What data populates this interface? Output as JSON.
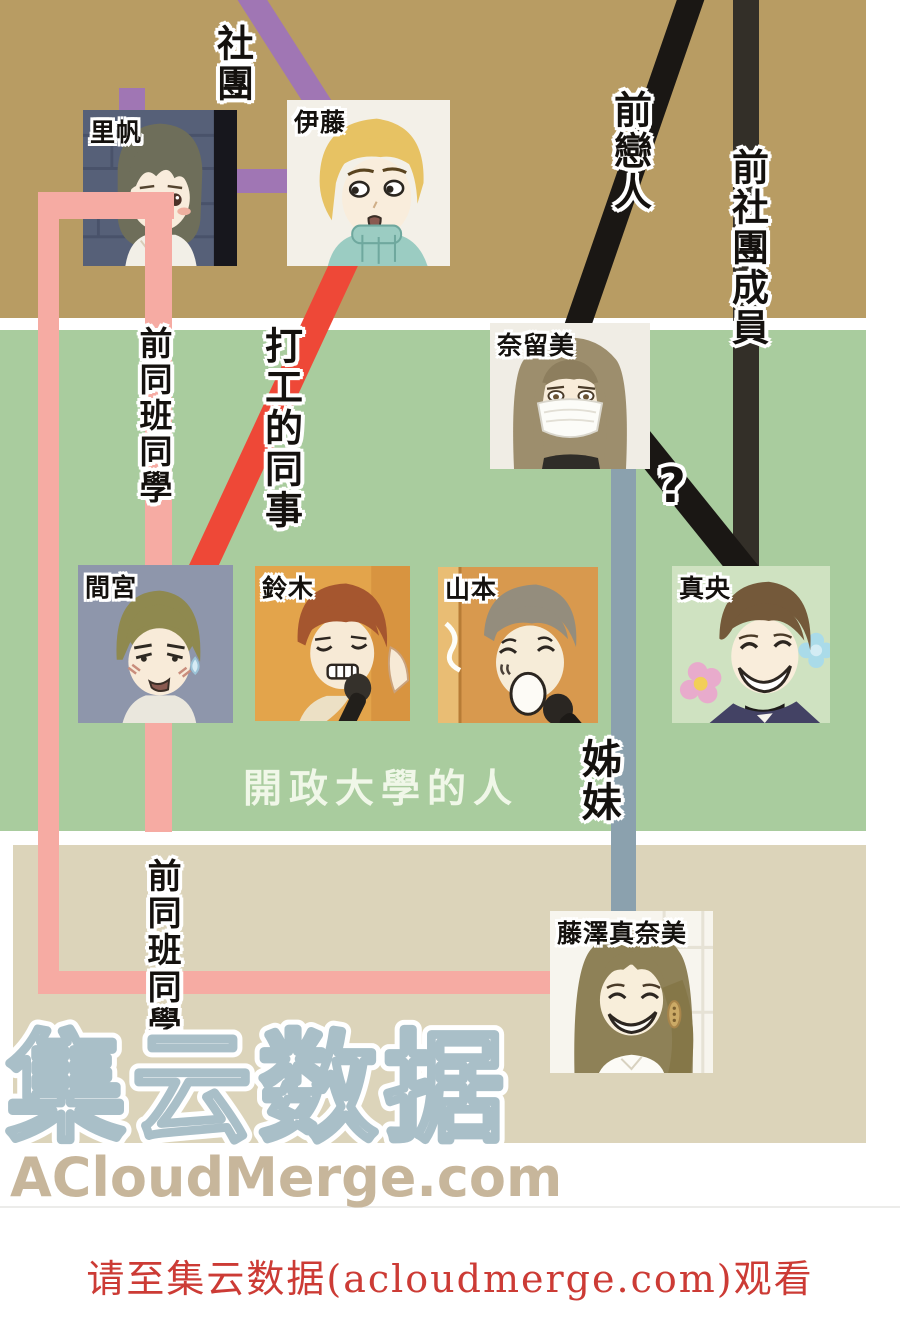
{
  "diagram": {
    "group_caption": "開政大學的人",
    "watermark_title": "集云数据",
    "watermark_site": "ACloudMerge.com",
    "footer_notice": "请至集云数据(acloudmerge.com)观看"
  },
  "characters": [
    {
      "id": "riho",
      "name": "里帆"
    },
    {
      "id": "ito",
      "name": "伊藤"
    },
    {
      "id": "narumi",
      "name": "奈留美"
    },
    {
      "id": "mamiya",
      "name": "間宮"
    },
    {
      "id": "suzuki",
      "name": "鈴木"
    },
    {
      "id": "yamamoto",
      "name": "山本"
    },
    {
      "id": "mao",
      "name": "真央"
    },
    {
      "id": "manami",
      "name": "藤澤真奈美"
    }
  ],
  "labels": {
    "club": "社團",
    "ex_lover": "前戀人",
    "ex_club_member": "前社團成員",
    "former_classmate_upper": "前同班同學",
    "part_time_coworker": "打工的同事",
    "unknown_relation": "?",
    "sisters": "姊妹",
    "former_classmate_lower": "前同班同學"
  },
  "edges": [
    {
      "from": "riho",
      "to": "ito",
      "label": "社團",
      "color": "#a076b4"
    },
    {
      "from": "offscreen-top",
      "to": "ito",
      "label": "社團",
      "color": "#a076b4"
    },
    {
      "from": "ito",
      "to": "mamiya",
      "label": "打工的同事",
      "color": "#ee4837"
    },
    {
      "from": "riho",
      "to": "manami",
      "label": "前同班同學",
      "color": "#f6aba3"
    },
    {
      "from": "offscreen-top",
      "to": "narumi",
      "label": "前戀人",
      "color": "#1a1714"
    },
    {
      "from": "offscreen-top",
      "to": "mao",
      "label": "前社團成員",
      "color": "#332f28"
    },
    {
      "from": "narumi",
      "to": "mao",
      "label": "?",
      "color": "#1a1714"
    },
    {
      "from": "narumi",
      "to": "manami",
      "label": "姊妹",
      "color": "#8ba1ae"
    }
  ],
  "colors": {
    "band_tan": "#b89c63",
    "band_green": "#a9cc9e",
    "band_beige": "#dcd4ba",
    "line_club_purple": "#a076b4",
    "line_classmate_pink": "#f6aba3",
    "line_coworker_red": "#ee4837",
    "line_ex_lover_black": "#1a1714",
    "line_ex_club_dark": "#332f28",
    "line_sisters_bluegray": "#8ba1ae",
    "watermark_outline": "#a9bfc8",
    "watermark_site_text": "#c7b69b",
    "footer_text": "#cc3b35"
  }
}
